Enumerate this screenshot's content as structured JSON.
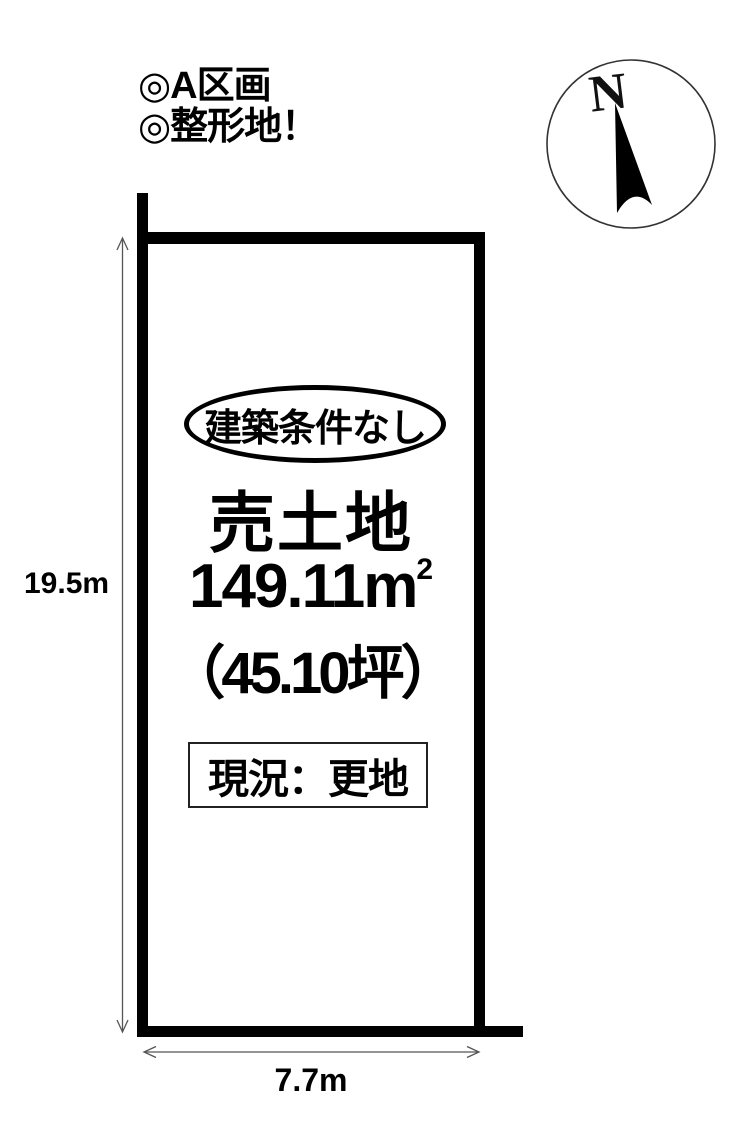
{
  "page": {
    "background": "#ffffff",
    "ink": "#000000",
    "dimension_line_color": "#555555"
  },
  "header": {
    "line1": "◎A区画",
    "line2": "◎整形地！"
  },
  "compass": {
    "label": "N"
  },
  "parcel": {
    "badge": "建築条件なし",
    "title": "売土地",
    "area_value": "149.11m",
    "area_sup": "2",
    "tsubo": "（45.10坪）",
    "status": "現況：更地"
  },
  "dimensions": {
    "height_label": "19.5m",
    "width_label": "7.7m"
  }
}
